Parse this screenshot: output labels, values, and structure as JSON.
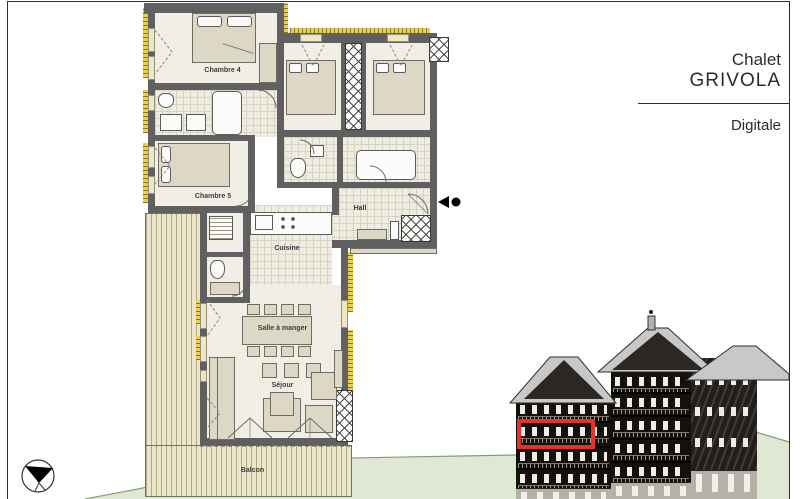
{
  "title_block": {
    "line1": "Chalet",
    "line2": "GRIVOLA",
    "subtitle": "Digitale"
  },
  "floor_plan": {
    "rooms": {
      "chambre4": "Chambre 4",
      "chambre5": "Chambre 5",
      "hall": "Hall",
      "cuisine": "Cuisine",
      "salle_a_manger": "Salle à manger",
      "sejour": "Séjour",
      "balcon": "Balcon"
    }
  },
  "elevation": {
    "highlight_color": "#e8312a"
  },
  "colors": {
    "wall": "#606060",
    "insulation": "#e8d052",
    "terrain": "#dfe8d2",
    "floor": "#f1eee5"
  }
}
